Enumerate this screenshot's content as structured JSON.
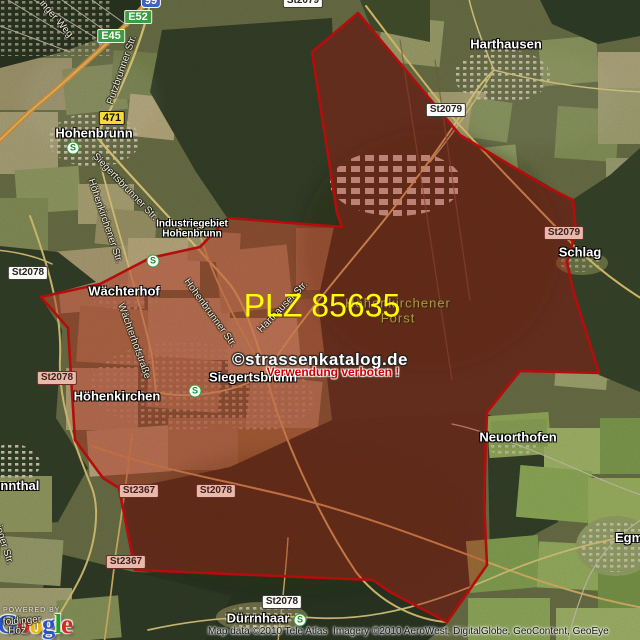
{
  "map": {
    "plz": {
      "label": "PLZ 85635",
      "color": "#ffff00"
    },
    "forest_label": {
      "line1": "Höhenkirchener",
      "line2": "Forst",
      "color": "#a59a48"
    },
    "watermark": {
      "brand": "©strassenkatalog.de",
      "warning": "Verwendung verboten !",
      "warning_color": "#cc0000"
    },
    "attribution": "Map data ©2010 Tele Atlas  Imagery ©2010 AeroWest, DigitalGlobe, GeoContent, GeoEye",
    "logo": {
      "powered_by": "POWERED BY",
      "letters": [
        "G",
        "o",
        "o",
        "g",
        "l",
        "e"
      ],
      "colors": [
        "#2a52c4",
        "#d42b1e",
        "#efb700",
        "#2a52c4",
        "#1ea229",
        "#d42b1e"
      ]
    },
    "boundary_color": "#cf0e0e"
  },
  "places": {
    "hohenbrunn": "Hohenbrunn",
    "harthausen": "Harthausen",
    "waechterhof": "Wächterhof",
    "hoehenkirchen": "Höhenkirchen",
    "siegertsbrunn": "Siegertsbrunn",
    "schlag": "Schlag",
    "neuorthofen": "Neuorthofen",
    "egmating": "Egmating",
    "brunnthal": "Brunnthal",
    "duerrnhaar": "Dürrnhaar",
    "industriegebiet_line1": "Industriegebiet",
    "industriegebiet_line2": "Hohenbrunn"
  },
  "streets": {
    "putzbrunner": "Putzbrunner Str.",
    "siegertsbrunner": "Siegertsbrunner Str.",
    "hoehenkirchener": "Höhenkirchener Str.",
    "hohenbrunner": "Hohenbrunner Str.",
    "waechterhofstrasse": "Wächterhofstraße",
    "harthauser": "Harthauser Str.",
    "weg_fragment": "inger Weg",
    "str_fragment": "inger Str.",
    "foldinger_fragment": "foldinger",
    "hoez_fragment": "Höz"
  },
  "shields": {
    "a99": "99",
    "e52": "E52",
    "e45": "E45",
    "b471": "471",
    "st2079": "St2079",
    "st2078": "St2078",
    "st2367": "St2367"
  },
  "icons": {
    "sbahn_letter": "S"
  }
}
